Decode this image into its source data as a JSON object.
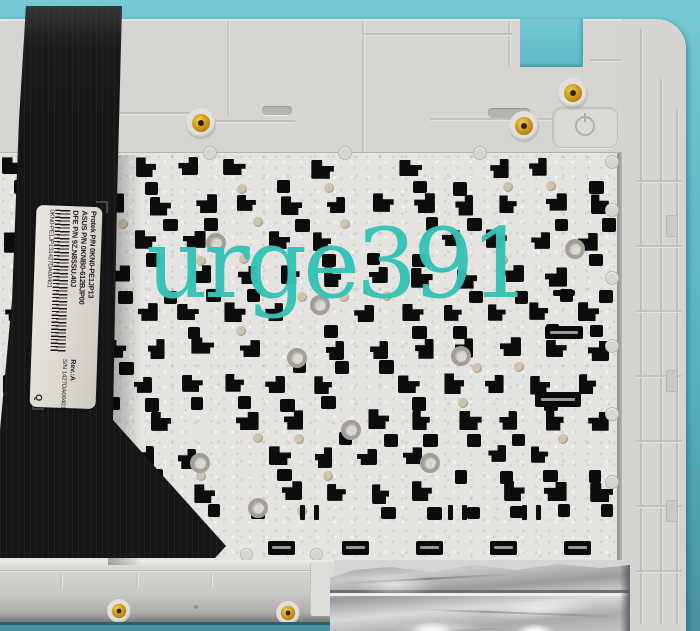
{
  "watermark": {
    "text": "urge391",
    "color": "#35c2b5"
  },
  "part_label": {
    "protek_pn": "Protek P/N 0KN0-PE1JP13",
    "asus_pn": "ASUS P/N 0KNB0-612BJP00",
    "dfe_pn": "DFE P/N 9Z.N8SSU.40J",
    "barcode_value": "0KN0-PE1JP131427DA00401",
    "revision": "Rev.:A",
    "serial": "S/N 1427DA00401",
    "inspection_mark": "Q"
  },
  "colors": {
    "background_teal": "#63bccb",
    "background_teal_dark": "#47929f",
    "plastic_white": "#d7d5d1",
    "plate_silver": "#e5e4e0",
    "cable_black": "#161616",
    "brass_insert": "#d29a1c",
    "foil_silver": "#c2c4c6",
    "watermark_teal": "#35c2b5"
  }
}
